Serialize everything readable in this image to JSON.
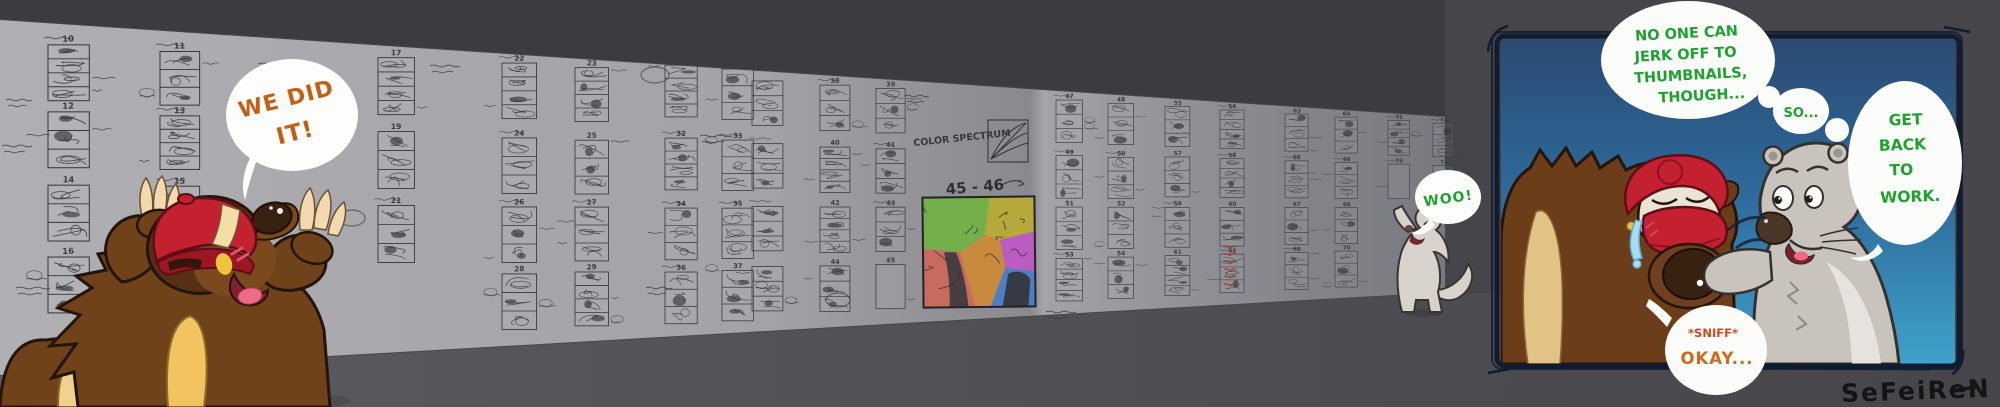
{
  "scene": {
    "background_color": "#46464a",
    "top_shadow_color": "#3c3c40",
    "floor_color": "#5b5b5f",
    "wall_light_color": "#b0b0b4",
    "wall_dark_color": "#797980",
    "pencil_color": "#36363e",
    "accent_orange": "#c65d13",
    "accent_green": "#1ca32e",
    "accent_red_orange": "#d4491c",
    "panel_blue_top": "#2a4a72",
    "panel_blue_bottom": "#3fa2ca",
    "panel_frame_color": "#121c30",
    "cap_red": "#c32030",
    "fur_brown": "#6f421a",
    "fur_gold": "#f2c45f",
    "ferret_gray": "#c9c3bd"
  },
  "bubbles": {
    "we_did_it": {
      "lines": [
        "WE DID",
        "IT!"
      ],
      "color": "#c65d13"
    },
    "woo": {
      "text": "WOO!",
      "color": "#1ca32e"
    },
    "no_one": {
      "lines": [
        "NO ONE CAN",
        "JERK OFF TO",
        "THUMBNAILS,",
        "THOUGH..."
      ],
      "color": "#1ca32e"
    },
    "so": {
      "text": "SO...",
      "color": "#1ca32e"
    },
    "get_back": {
      "lines": [
        "GET",
        "BACK",
        "TO",
        "WORK."
      ],
      "color": "#1ca32e"
    },
    "sniff_okay": {
      "sniff": "*SNIFF*",
      "okay": "OKAY...",
      "sniff_color": "#d4491c",
      "okay_color": "#d2691b"
    }
  },
  "signature": "SeFeiReN",
  "wall": {
    "color_spectrum_label": "COLOR SPECTRUM",
    "page_range_label": "45 - 46",
    "color_thumbnail_patch_colors": [
      "#74b04a",
      "#b5a93c",
      "#bb5cc0",
      "#c96a5e",
      "#c98a3e",
      "#4c7fc8"
    ],
    "groups": [
      {
        "numbers": [
          "10",
          "11",
          "12",
          "13",
          "14",
          "15",
          "16"
        ]
      },
      {
        "numbers": [
          "17",
          "19",
          "21"
        ]
      },
      {
        "numbers": [
          "22",
          "23",
          "24",
          "25",
          "26",
          "27",
          "28",
          "29"
        ]
      },
      {
        "numbers": [
          "30",
          "31",
          "32",
          "33",
          "34",
          "35",
          "36",
          "37"
        ]
      },
      {
        "numbers": [
          "",
          "",
          "",
          ""
        ]
      },
      {
        "numbers": [
          "38",
          "39",
          "40",
          "41",
          "42",
          "43",
          "44",
          "45"
        ],
        "empty": [
          "45"
        ]
      },
      {
        "numbers": [
          "47",
          "48",
          "49",
          "50",
          "51",
          "52",
          "53",
          "54"
        ]
      },
      {
        "numbers": [
          "55",
          "56",
          "57",
          "58",
          "59",
          "60",
          "61",
          "62"
        ]
      },
      {
        "numbers": [
          "63",
          "64",
          "65",
          "66",
          "67",
          "68",
          "69",
          "70"
        ]
      },
      {
        "numbers": [
          "71",
          "72",
          "73",
          "74"
        ],
        "empty": [
          "73",
          "74"
        ]
      }
    ]
  }
}
